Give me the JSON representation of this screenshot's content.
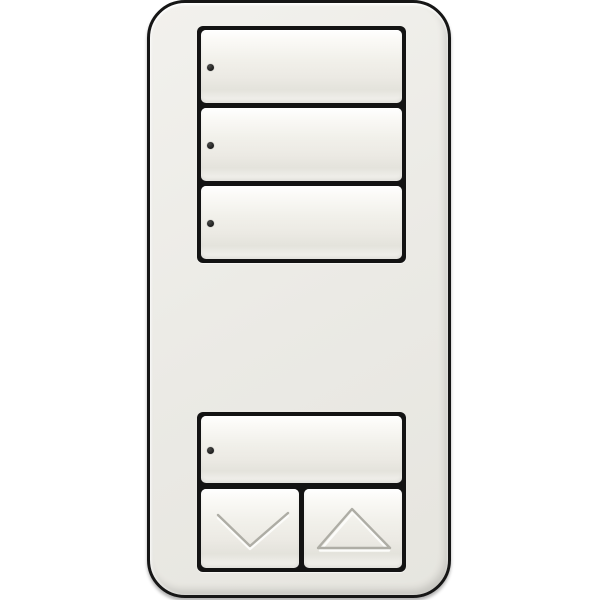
{
  "colors": {
    "background": "#ffffff",
    "body": "#ebeae5",
    "outline": "#161616",
    "frame": "#131313",
    "button_highlight": "#ffffff",
    "button_face": "#f1f0ea",
    "button_shadow": "#e4e3dc",
    "led": "#1c1c1c",
    "glyph_stroke": "#aeada5",
    "glyph_highlight": "#fcfcfa"
  },
  "keypad": {
    "scene_buttons": [
      {
        "name": "scene-button-1",
        "icon": "led-indicator-dot",
        "led_state": "off",
        "label": ""
      },
      {
        "name": "scene-button-2",
        "icon": "led-indicator-dot",
        "led_state": "off",
        "label": ""
      },
      {
        "name": "scene-button-3",
        "icon": "led-indicator-dot",
        "led_state": "off",
        "label": ""
      }
    ],
    "bottom_group": {
      "main_button": {
        "name": "scene-button-main",
        "icon": "led-indicator-dot",
        "led_state": "off",
        "label": ""
      },
      "lower_button": {
        "name": "lower-button",
        "icon": "chevron-down-icon",
        "label": ""
      },
      "raise_button": {
        "name": "raise-button",
        "icon": "triangle-up-icon",
        "label": ""
      }
    }
  }
}
